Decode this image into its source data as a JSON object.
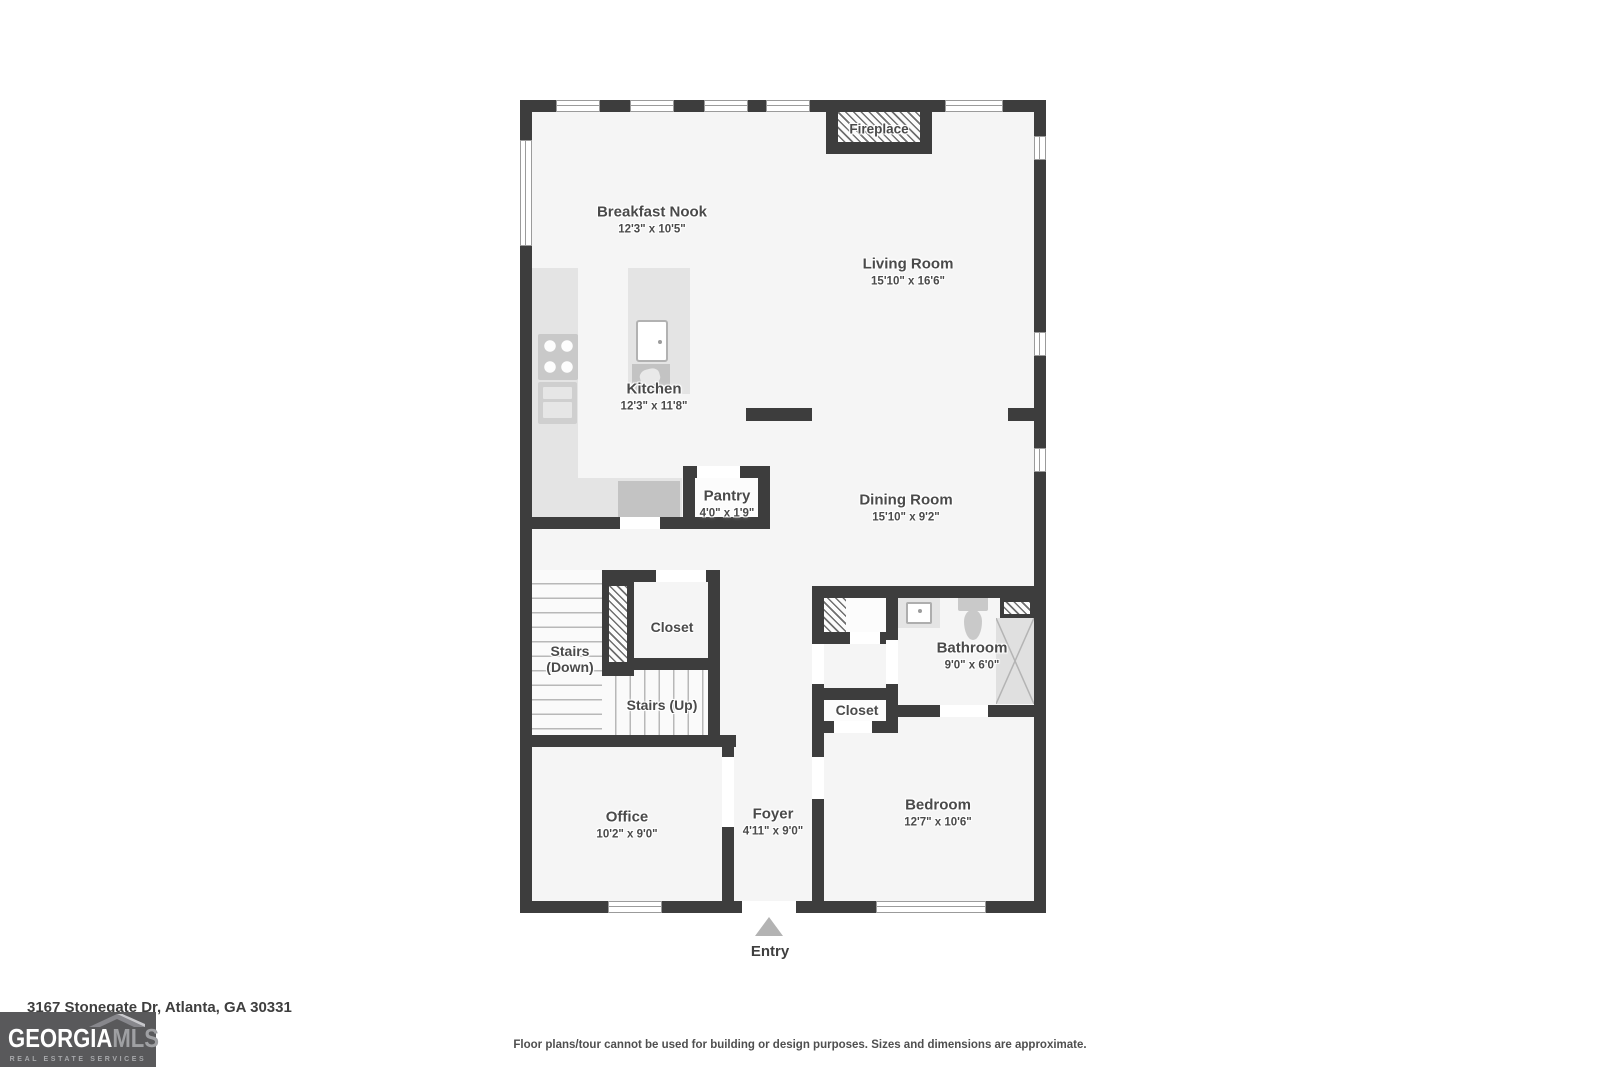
{
  "plan": {
    "rooms": [
      {
        "name": "Breakfast Nook",
        "dims": "12'3\" x 10'5\""
      },
      {
        "name": "Living Room",
        "dims": "15'10\" x 16'6\""
      },
      {
        "name": "Kitchen",
        "dims": "12'3\" x 11'8\""
      },
      {
        "name": "Pantry",
        "dims": "4'0\" x 1'9\""
      },
      {
        "name": "Dining Room",
        "dims": "15'10\" x 9'2\""
      },
      {
        "name": "Bathroom",
        "dims": "9'0\" x 6'0\""
      },
      {
        "name": "Office",
        "dims": "10'2\" x 9'0\""
      },
      {
        "name": "Foyer",
        "dims": "4'11\" x 9'0\""
      },
      {
        "name": "Bedroom",
        "dims": "12'7\" x 10'6\""
      }
    ],
    "features": {
      "fireplace": "Fireplace",
      "stairs_down_line1": "Stairs",
      "stairs_down_line2": "(Down)",
      "stairs_up": "Stairs (Up)",
      "hall_closet": "Closet",
      "bedroom_closet": "Closet",
      "entry": "Entry"
    }
  },
  "footer": {
    "address": "3167 Stonegate Dr, Atlanta, GA 30331",
    "disclaimer": "Floor plans/tour cannot be used for building or design purposes. Sizes and dimensions are approximate.",
    "logo": {
      "brand_primary": "GEORGIA",
      "brand_secondary": "MLS",
      "tagline": "REAL ESTATE SERVICES"
    }
  },
  "colors": {
    "wall": "#3d3d3d",
    "floor": "#f5f5f5",
    "fixture_gray": "#c9c9c9",
    "logo_background": "#59595b"
  }
}
